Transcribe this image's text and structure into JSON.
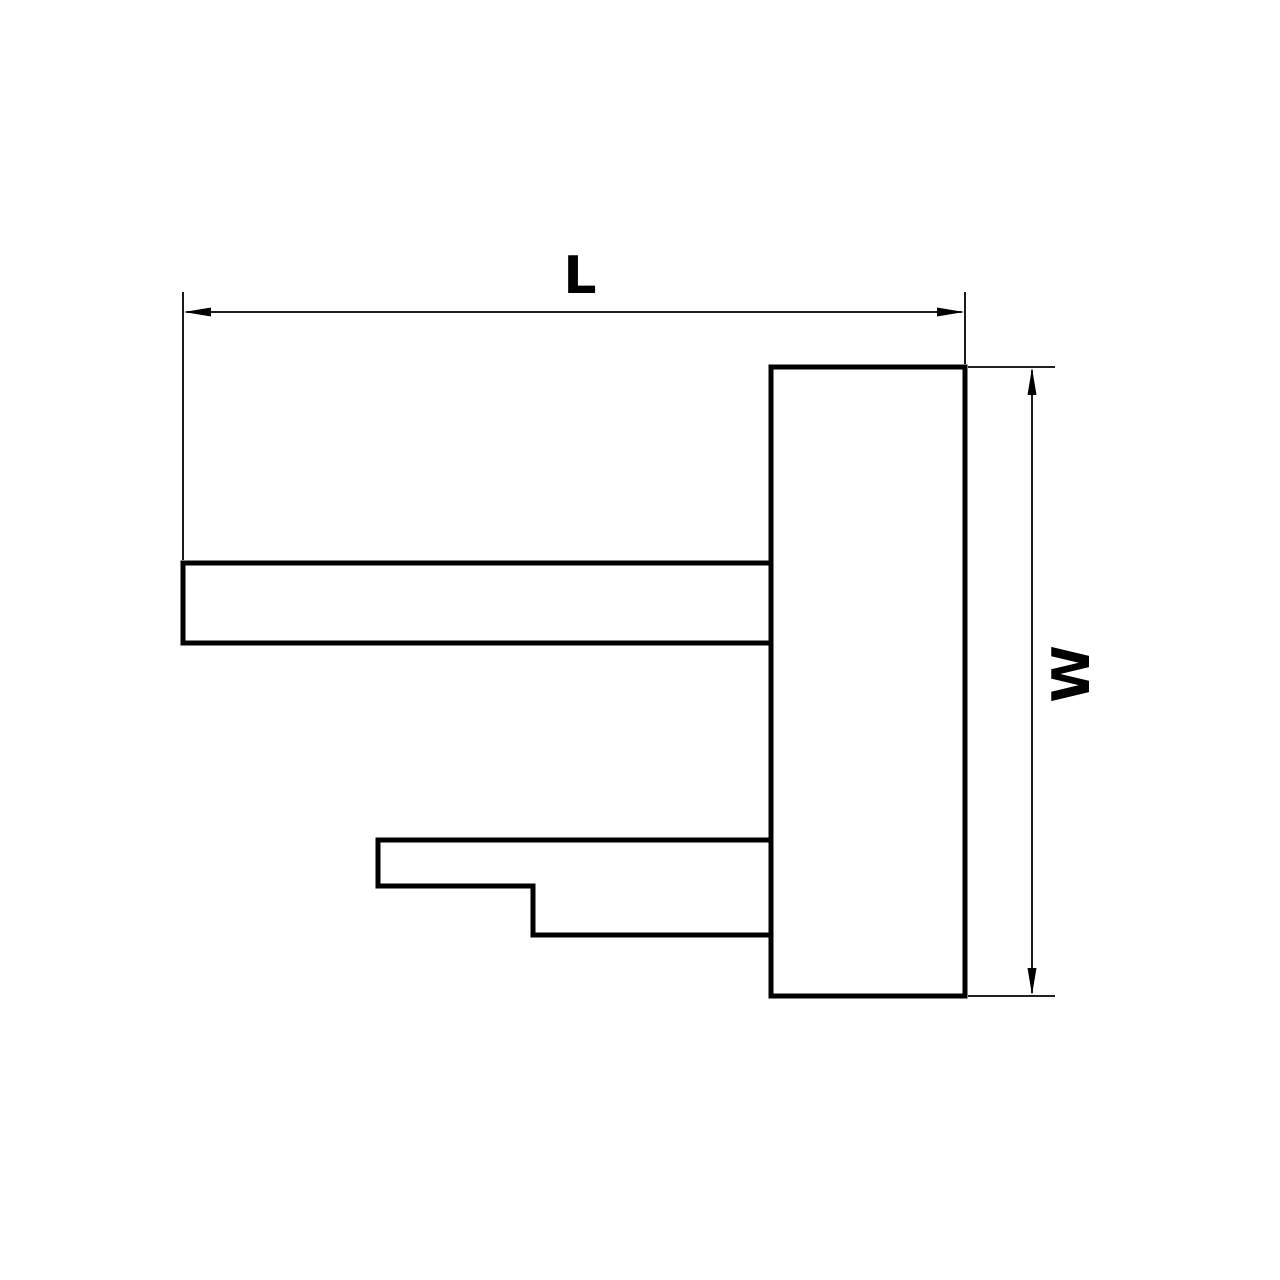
{
  "figure": {
    "type": "technical-drawing",
    "description": "Orthographic side-profile drawing of a machined part: a tall vertical body plate with an upper straight arm and a lower stepped arm extending to the left, annotated with overall length and width dimensions.",
    "colors": {
      "background": "#ffffff",
      "line": "#000000"
    },
    "dimensions": {
      "length": {
        "label": "L",
        "orientation": "horizontal",
        "position": "top"
      },
      "width": {
        "label": "W",
        "orientation": "vertical",
        "position": "right",
        "text_rotation_deg": -90
      }
    }
  }
}
